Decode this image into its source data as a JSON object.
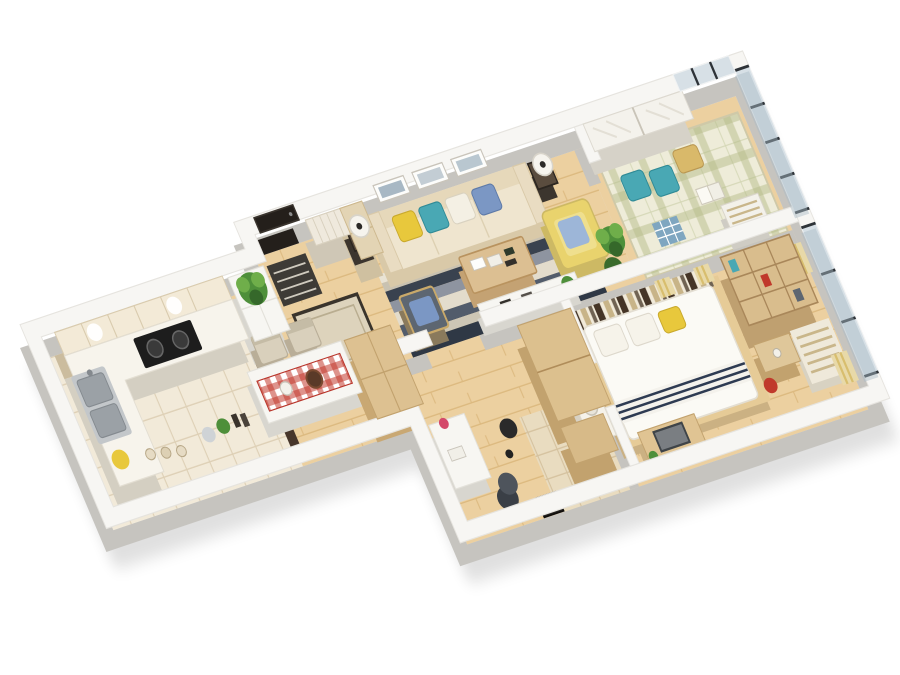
{
  "meta": {
    "scene_type": "3d-apartment-floor-plan-render",
    "view": "isometric-cutaway",
    "background": "#ffffff",
    "visible_text": ""
  },
  "palette": {
    "wall_top": "#f7f6f3",
    "wall_side": "#c6c4bf",
    "floor_wood": "#ecd0a0",
    "plank_line": "#dcb97f",
    "tile_kitchen": "#f2ead9",
    "tile_grout": "#ded0b6",
    "tile_bath": "#e9dcc0",
    "bath_grout": "#d5c29f",
    "balcony_mat": "#eeecd9",
    "plaid_line": "#b5bc8a",
    "glass": "#a9bac6",
    "glass_frame": "#2e3338",
    "sofa": "#efe5cf",
    "sofa_side": "#d9c9a8",
    "pillow_yellow": "#e8c83c",
    "pillow_teal": "#49a8b4",
    "pillow_blue": "#7b97c4",
    "armchair_yellow": "#e9d36d",
    "chair_gray": "#5d6671",
    "rug_navy": "#39424f",
    "rug_cream": "#e9e3d4",
    "rug_slate": "#8e94a0",
    "wood_furniture": "#d9bd8d",
    "wood_side": "#c2a26e",
    "white_furniture": "#f7f6f2",
    "bed_duvet": "#fbfaf5",
    "headboard_dark": "#453527",
    "headboard_light": "#f1ead9",
    "headboard_tan": "#c8b488",
    "runner_red": "#c23b2e",
    "door_black": "#241f1b",
    "cooktop": "#1d1d1d",
    "steel": "#9ba1a6",
    "plant": "#4e8f3a",
    "accent_pink": "#d4496a",
    "accent_red": "#c0392b",
    "curtain_gold": "#d8be6e",
    "shadow": "#000000"
  },
  "rooms": [
    {
      "id": "kitchen",
      "label": "Kitchen",
      "furniture": [
        "upper cabinets",
        "L-shaped counter",
        "gas cooktop",
        "double sink",
        "yellow flowers",
        "spice jars",
        "shelf items",
        "plant cabinet",
        "tiled floor"
      ]
    },
    {
      "id": "entry-hall",
      "label": "Entry Hall",
      "furniture": [
        "black front door",
        "striped doormat",
        "shoe cabinet",
        "bordered hall rug",
        "tall hallway cabinet"
      ]
    },
    {
      "id": "dining",
      "label": "Dining Area",
      "furniture": [
        "white dining table",
        "red gingham runner",
        "two beige chairs",
        "cake",
        "pitcher",
        "wooden sideboard"
      ]
    },
    {
      "id": "living-room",
      "label": "Living Room",
      "furniture": [
        "cream three-seat sofa",
        "yellow teal blue pillows",
        "two side tables with drum lamps",
        "gray accent chair with blue pillow",
        "yellow armchair",
        "wood coffee table",
        "striped area rug",
        "white media console",
        "three framed artworks",
        "floor plant"
      ]
    },
    {
      "id": "balcony",
      "label": "Tatami Balcony",
      "furniture": [
        "white sliding-door wardrobe",
        "plaid tatami mat",
        "teal cushions",
        "gold cushion",
        "open book",
        "striped bench",
        "floor-to-ceiling glass walls"
      ]
    },
    {
      "id": "bedroom",
      "label": "Bedroom",
      "furniture": [
        "double bed with white duvet",
        "striped headboard wall",
        "yellow pillow",
        "navy striped throw",
        "wood wardrobe columns",
        "cube bookshelf",
        "nightstand",
        "window seat with striped cushions",
        "gold striped curtains",
        "desk with monitor",
        "red stool",
        "glass window wall"
      ]
    },
    {
      "id": "study",
      "label": "Study Corner",
      "furniture": [
        "white desk",
        "pink vase",
        "office chair",
        "black floor lamp",
        "leaning poster"
      ]
    },
    {
      "id": "bathroom",
      "label": "Bath Corner",
      "furniture": [
        "vanity with basin",
        "potted plant",
        "beige tiled floor"
      ]
    }
  ]
}
